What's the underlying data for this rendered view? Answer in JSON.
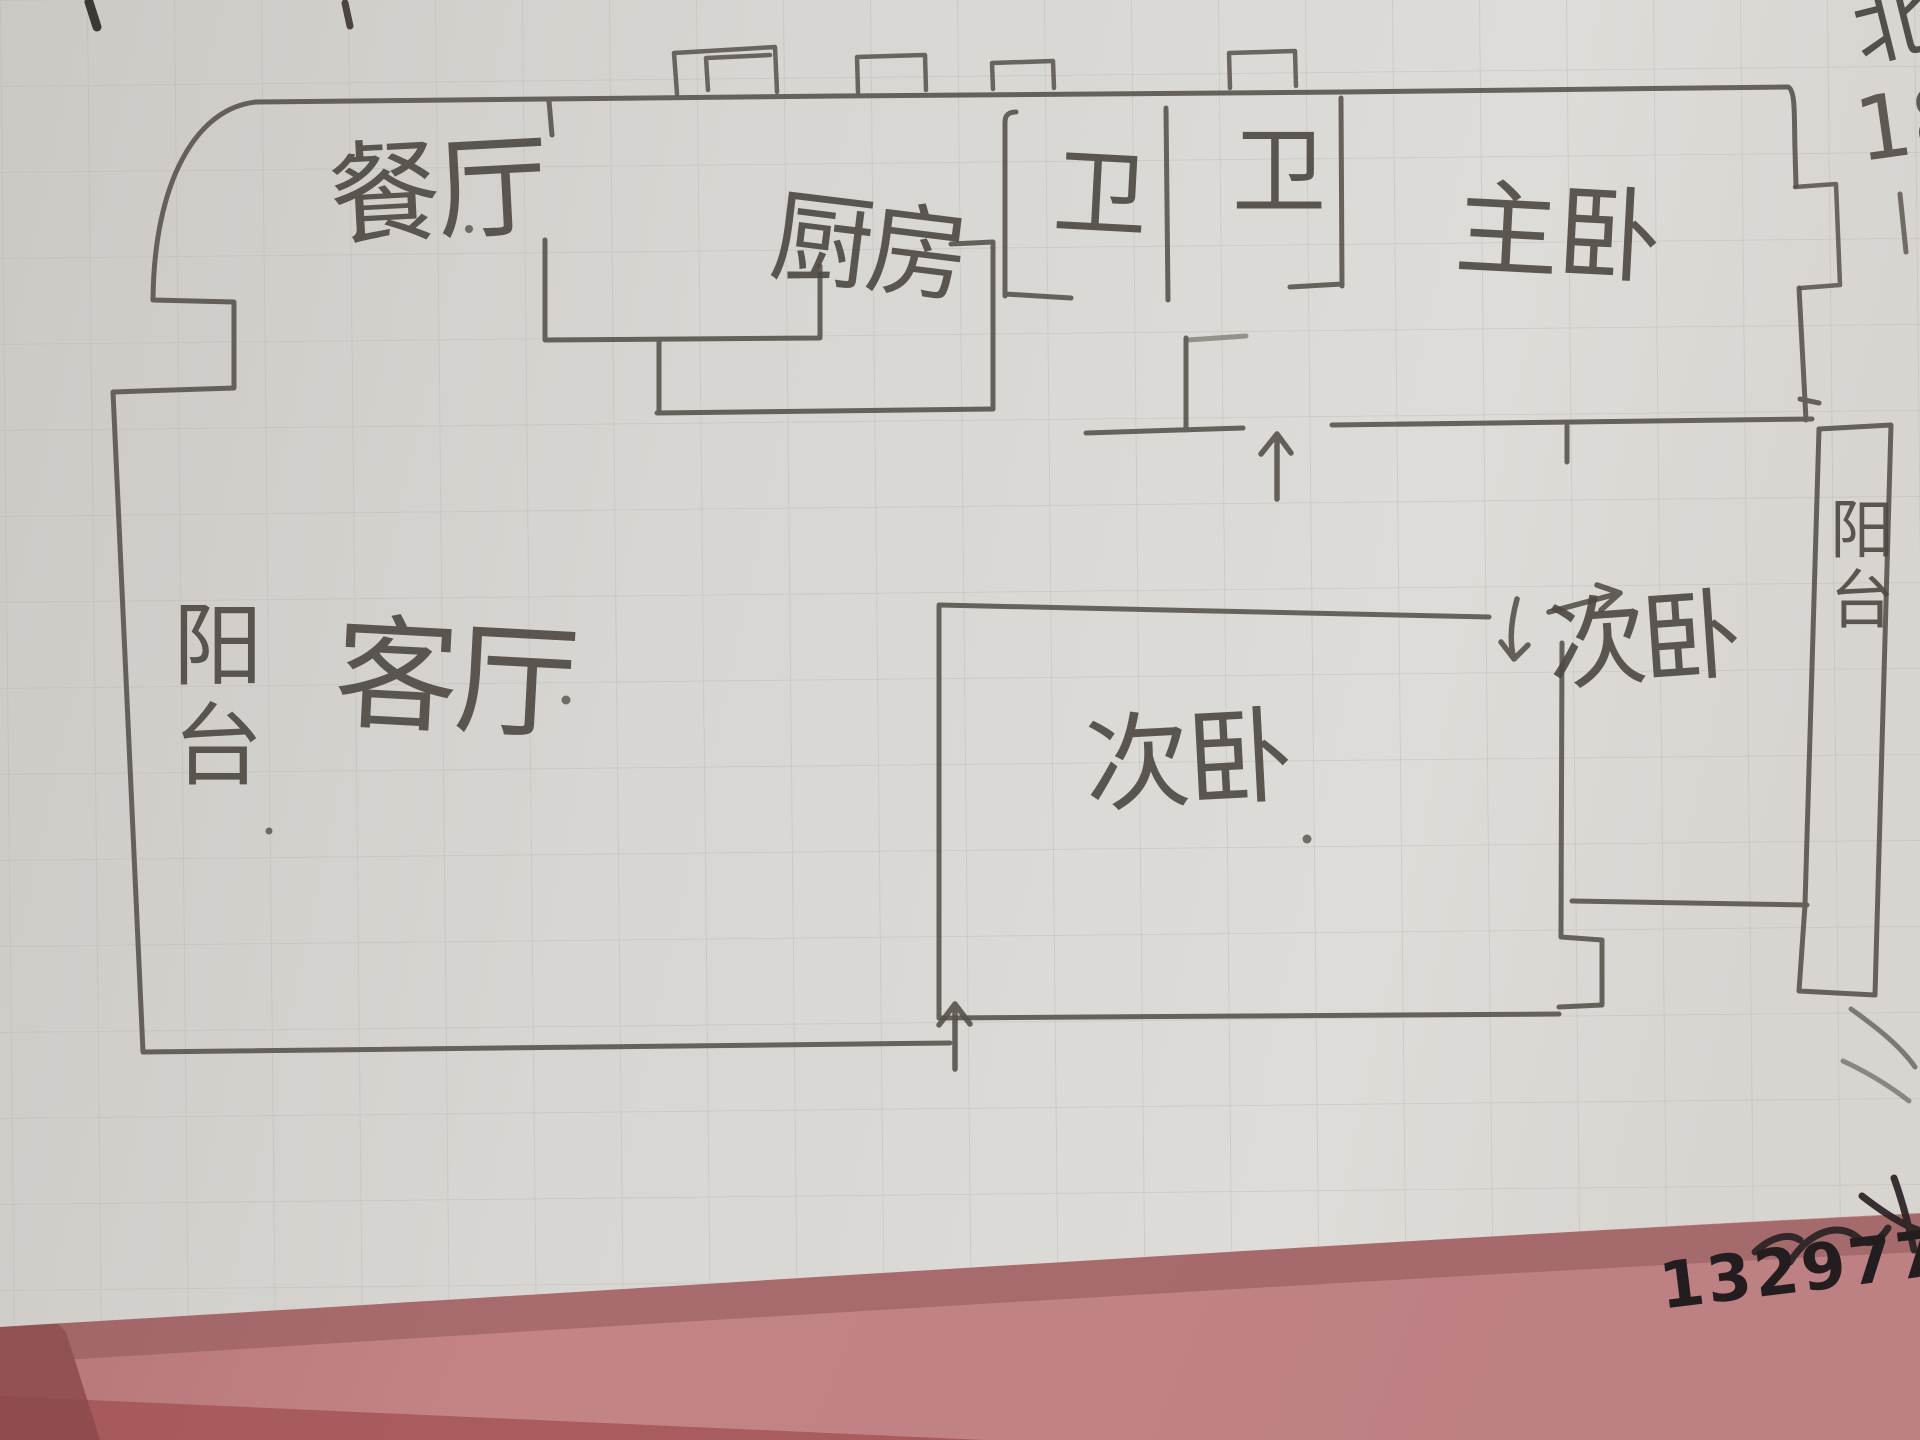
{
  "scene": {
    "description": "Photo of a hand-drawn apartment floor plan sketched in pencil on gridded paper lying on a pink surface",
    "colors": {
      "paper": "#d7d5d1",
      "pencil": "#56514a",
      "ink": "#241d1f",
      "background_pink": "#b97c7e"
    }
  },
  "rooms": {
    "dining": {
      "label": "餐厅"
    },
    "kitchen": {
      "label": "厨房"
    },
    "bath_1": {
      "label": "卫"
    },
    "bath_2": {
      "label": "卫"
    },
    "master_bedroom": {
      "label": "主卧"
    },
    "living": {
      "label": "客厅"
    },
    "balcony_left": {
      "label": "阳台"
    },
    "bedroom_center": {
      "label": "次卧"
    },
    "bedroom_right": {
      "label": "次卧"
    },
    "balcony_right": {
      "label": "阳台"
    }
  },
  "annotations": {
    "north_label": "北",
    "number": "18",
    "phone_partial": "13297779"
  }
}
